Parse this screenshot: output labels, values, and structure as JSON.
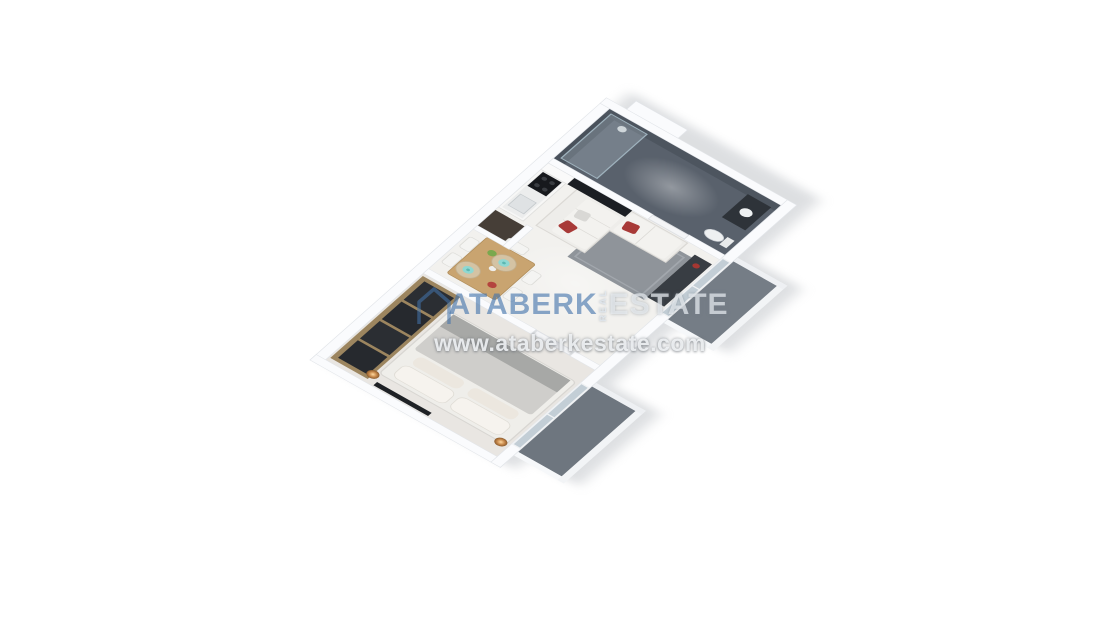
{
  "watermark": {
    "icon": "house-outline-icon",
    "brand_primary": "ATABERK",
    "brand_vertical": "REAL",
    "brand_secondary": "ESTATE",
    "url": "www.ataberkestate.com",
    "primary_color": "#4273ab",
    "secondary_color": "#e9eef2"
  },
  "scene": {
    "type": "3d-apartment-floor-plan-render",
    "background_color": "#ffffff",
    "rooms": [
      "bedroom",
      "living-room",
      "dining-area",
      "kitchen",
      "bathroom",
      "hallway",
      "bedroom-balcony",
      "living-balcony"
    ],
    "palette": {
      "wall_white": "#fafbfc",
      "floor_light": "#f2f1ee",
      "bedroom_floor": "#e9e6e2",
      "bathroom_slate": "#59616c",
      "balcony_gray": "#717983",
      "table_wood": "#c9a470",
      "wardrobe_wood": "#9c855f",
      "glass_dark": "#26292e",
      "sofa_white": "#eeedea",
      "accent_red": "#a83a38",
      "accent_teal": "#8fd8d2",
      "lamp_amber": "#c98b4e",
      "rug_gray": "#8f949a"
    }
  }
}
